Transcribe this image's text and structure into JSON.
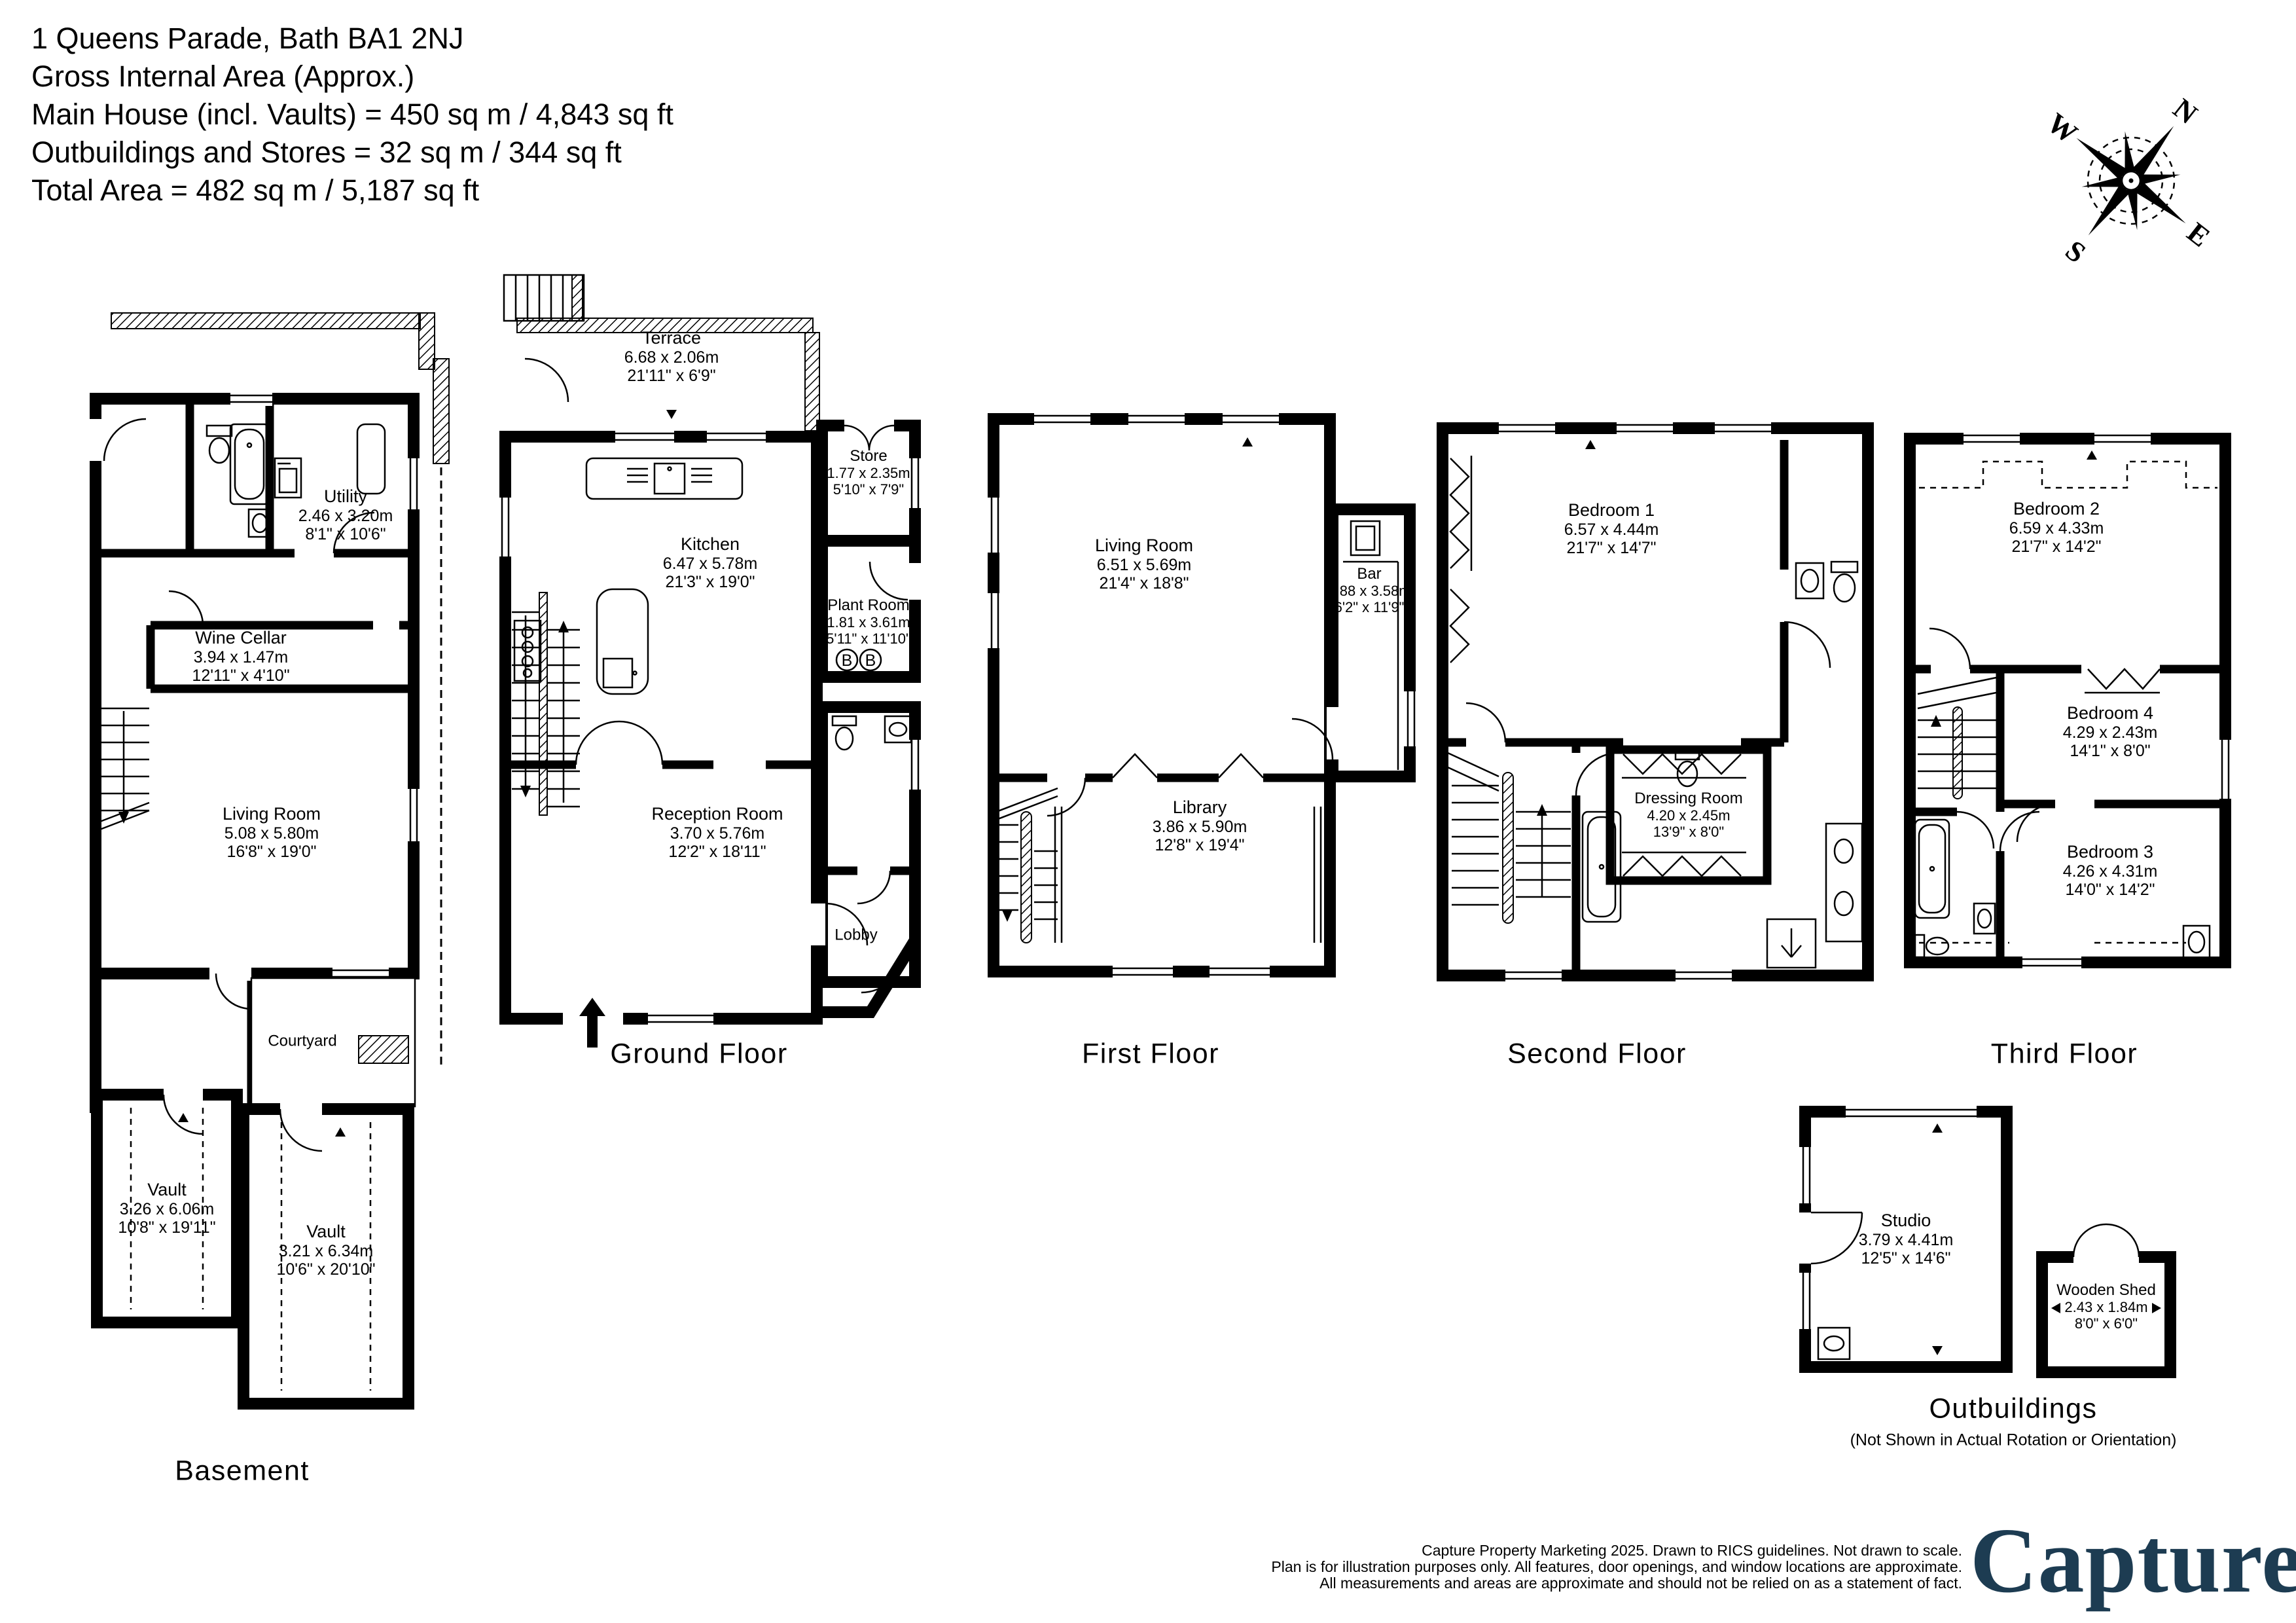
{
  "header": {
    "line1": "1 Queens Parade, Bath BA1 2NJ",
    "line2": "Gross Internal Area (Approx.)",
    "line3": "Main House (incl. Vaults) = 450 sq m / 4,843 sq ft",
    "line4": "Outbuildings and Stores = 32 sq m / 344 sq ft",
    "line5": "Total Area = 482 sq m / 5,187 sq ft"
  },
  "compass": {
    "n": "N",
    "e": "E",
    "s": "S",
    "w": "W"
  },
  "floors": {
    "basement": {
      "name": "Basement",
      "rooms": {
        "utility": {
          "name": "Utility",
          "metric": "2.46 x 3.20m",
          "imperial": "8'1\" x 10'6\""
        },
        "wine_cellar": {
          "name": "Wine Cellar",
          "metric": "3.94 x 1.47m",
          "imperial": "12'11\" x 4'10\""
        },
        "living_room": {
          "name": "Living Room",
          "metric": "5.08 x 5.80m",
          "imperial": "16'8\" x 19'0\""
        },
        "courtyard": {
          "name": "Courtyard"
        },
        "vault_1": {
          "name": "Vault",
          "metric": "3.26 x 6.06m",
          "imperial": "10'8\" x 19'11\""
        },
        "vault_2": {
          "name": "Vault",
          "metric": "3.21 x 6.34m",
          "imperial": "10'6\" x 20'10\""
        }
      }
    },
    "ground": {
      "name": "Ground Floor",
      "boilers": [
        "B",
        "B"
      ],
      "rooms": {
        "terrace": {
          "name": "Terrace",
          "metric": "6.68 x 2.06m",
          "imperial": "21'11\" x 6'9\""
        },
        "kitchen": {
          "name": "Kitchen",
          "metric": "6.47 x 5.78m",
          "imperial": "21'3\" x 19'0\""
        },
        "store": {
          "name": "Store",
          "metric": "1.77 x 2.35m",
          "imperial": "5'10\" x 7'9\""
        },
        "plant_room": {
          "name": "Plant Room",
          "metric": "1.81 x 3.61m",
          "imperial": "5'11\" x 11'10\""
        },
        "reception_room": {
          "name": "Reception Room",
          "metric": "3.70 x 5.76m",
          "imperial": "12'2\" x 18'11\""
        },
        "lobby": {
          "name": "Lobby"
        }
      }
    },
    "first": {
      "name": "First Floor",
      "rooms": {
        "living_room": {
          "name": "Living Room",
          "metric": "6.51 x 5.69m",
          "imperial": "21'4\" x 18'8\""
        },
        "bar": {
          "name": "Bar",
          "metric": "1.88 x 3.58m",
          "imperial": "6'2\" x 11'9\""
        },
        "library": {
          "name": "Library",
          "metric": "3.86 x 5.90m",
          "imperial": "12'8\" x 19'4\""
        }
      }
    },
    "second": {
      "name": "Second Floor",
      "rooms": {
        "bedroom_1": {
          "name": "Bedroom 1",
          "metric": "6.57 x 4.44m",
          "imperial": "21'7\" x 14'7\""
        },
        "dressing_room": {
          "name": "Dressing Room",
          "metric": "4.20 x 2.45m",
          "imperial": "13'9\" x 8'0\""
        }
      }
    },
    "third": {
      "name": "Third Floor",
      "rooms": {
        "bedroom_2": {
          "name": "Bedroom 2",
          "metric": "6.59 x 4.33m",
          "imperial": "21'7\" x 14'2\""
        },
        "bedroom_4": {
          "name": "Bedroom 4",
          "metric": "4.29 x 2.43m",
          "imperial": "14'1\" x 8'0\""
        },
        "bedroom_3": {
          "name": "Bedroom 3",
          "metric": "4.26 x 4.31m",
          "imperial": "14'0\" x 14'2\""
        }
      }
    },
    "outbuildings": {
      "name": "Outbuildings",
      "note": "(Not Shown in Actual Rotation or Orientation)",
      "rooms": {
        "studio": {
          "name": "Studio",
          "metric": "3.79 x 4.41m",
          "imperial": "12'5\" x 14'6\""
        },
        "wooden_shed": {
          "name": "Wooden Shed",
          "metric": "2.43 x 1.84m",
          "imperial": "8'0\" x 6'0\""
        }
      }
    }
  },
  "footer": {
    "line1": "Capture Property Marketing 2025. Drawn to RICS guidelines.  Not drawn to scale.",
    "line2": "Plan is for illustration purposes only. All features, door openings, and window locations are approximate.",
    "line3": "All measurements and areas are approximate and should not be relied on as a statement of fact.",
    "logo_text": "Capture",
    "logo_dot": ".",
    "brand_navy": "#1d3c52",
    "brand_pink": "#d8195e"
  }
}
